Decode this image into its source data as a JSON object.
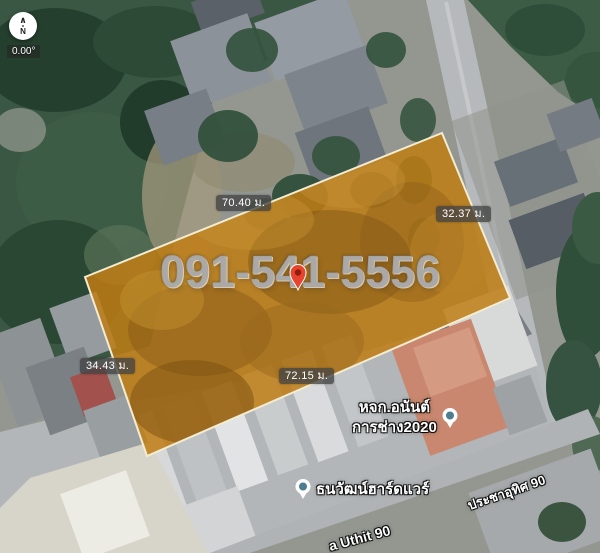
{
  "compass": {
    "needle": "∧",
    "north": "N",
    "heading": "0.00°"
  },
  "watermark": {
    "phone": "091-541-5556"
  },
  "plot": {
    "fill_color": "#bf7c14",
    "stroke_color": "#f2ecd2",
    "measurements": {
      "top": "70.40 ม.",
      "right": "32.37 ม.",
      "left": "34.43 ม.",
      "bottom": "72.15 ม."
    }
  },
  "pin": {
    "color": "#e8432c",
    "inner_color": "#8c1d10"
  },
  "pois": {
    "contractor": {
      "line1": "หจก.อนันต์",
      "line2": "การช่าง2020"
    },
    "hardware_store": {
      "name": "ธนวัฒน์ฮาร์ดแวร์"
    },
    "icon_dot_color": "#4d7d8f"
  },
  "streets": {
    "right": "ประชาอุทิศ 90",
    "bottom": "a Uthit 90"
  }
}
